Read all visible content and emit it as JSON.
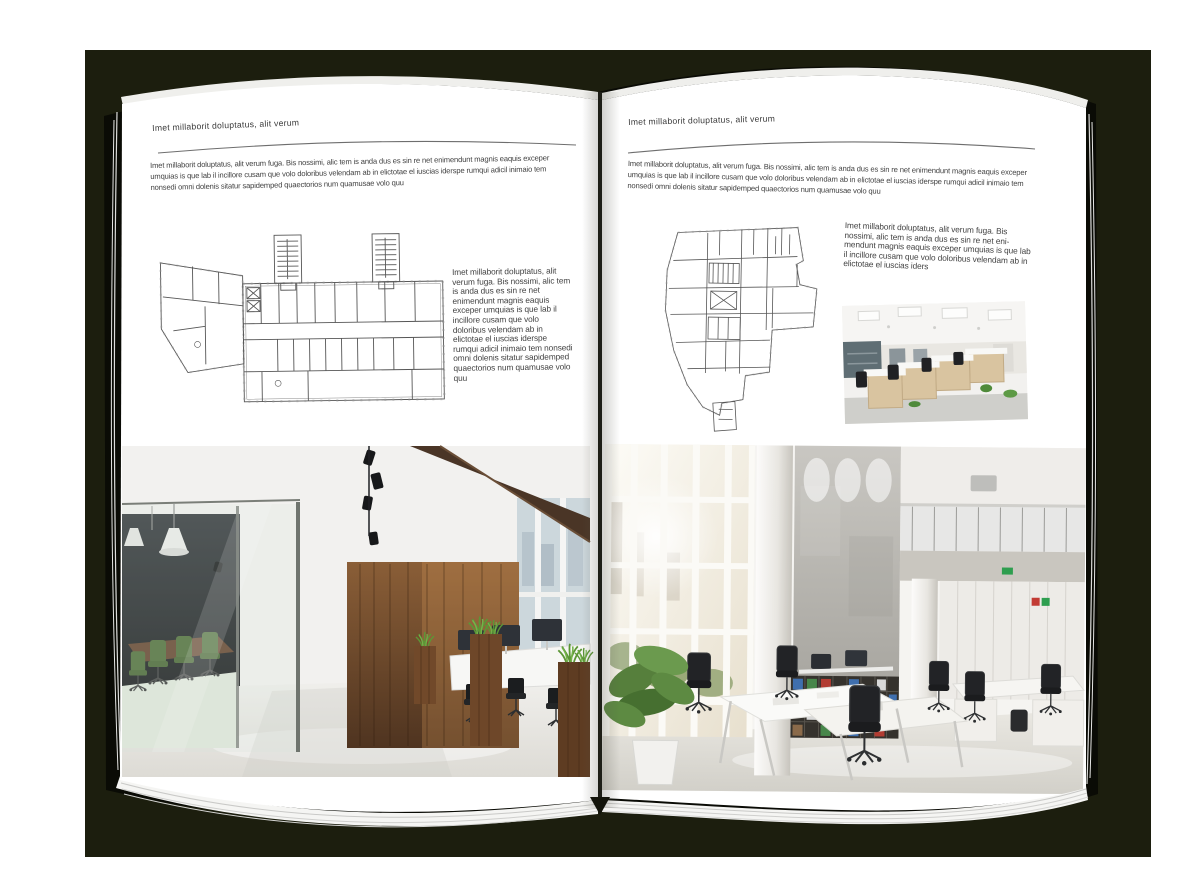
{
  "colors": {
    "backdrop": "#1c1e0e",
    "cover": "#0a0b05",
    "page": "#ffffff",
    "rule": "#6e6e6e",
    "body_text": "#424242"
  },
  "left_page": {
    "header": "Imet millaborit doluptatus, alit verum",
    "intro": "Imet millaborit doluptatus, alit verum fuga. Bis nossimi, alic tem is anda dus es sin re net enimendunt magnis eaquis exceper umquias is que lab il incillore cusam que volo doloribus velendam ab in elictotae el iuscias iderspe rumqui adicil inimaio tem nonsedi omni dolenis sitatur sapidemped quaectorios num quamusae volo quu",
    "side_text": "Imet millaborit doluptatus, alit verum fuga. Bis nossimi, alic tem is anda dus es sin re net enimendunt magnis eaquis exceper umquias is que lab il incillore cusam que volo doloribus velendam ab in elictotae el iuscias iderspe rumqui adicil inimaio tem nonsedi omni dolenis sitatur sapidemped quaectorios num quamusae volo quu"
  },
  "right_page": {
    "header": "Imet millaborit doluptatus, alit verum",
    "intro": "Imet millaborit doluptatus, alit verum fuga. Bis nossimi, alic tem is anda dus es sin re net enimendunt magnis eaquis exceper umquias is que lab il incillore cusam que volo doloribus velendam ab in elictotae el iuscias iderspe rumqui adicil inimaio tem nonsedi omni dolenis sitatur sapidemped quaectorios num quamusae volo quu",
    "side_text": "Imet millaborit doluptatus, alit verum fuga. Bis nossimi, alic tem is anda dus es sin re net eni-mendunt magnis eaquis exceper umquias is que lab il incillore cusam que volo doloribus velendam ab in elictotae el iuscias iders"
  }
}
